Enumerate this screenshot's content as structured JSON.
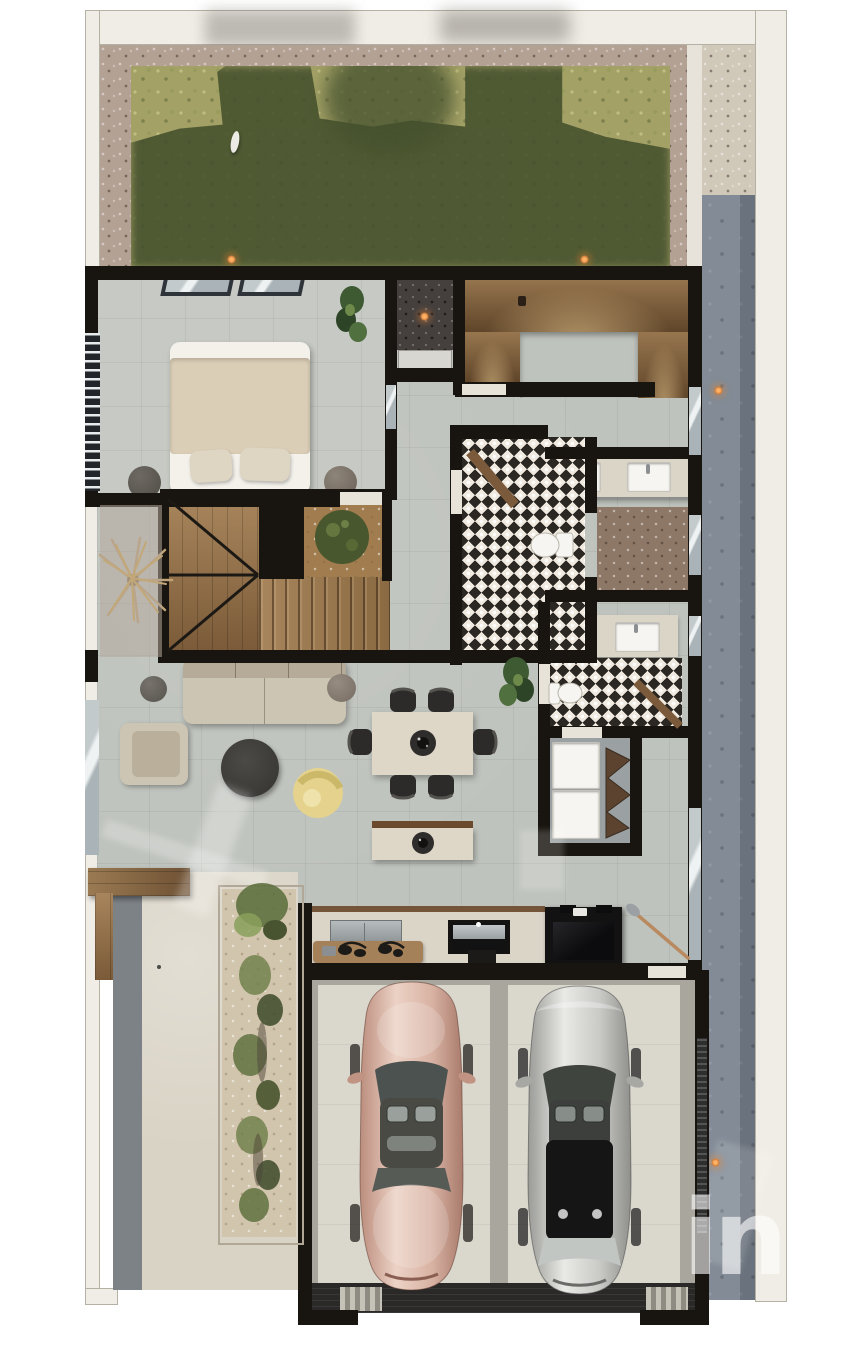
{
  "watermark": {
    "text": "in"
  },
  "palette": {
    "page-bg": "#ffffff",
    "outer-wall": "#f0ede6",
    "outer-wall-edge": "#b6b1a5",
    "wall": "#18140f",
    "door-threshold": "#e7e3d9",
    "garden-gravel": "#b3a193",
    "grass-light": "#a3a166",
    "grass-dark": "#44502d",
    "fence-light": "#e7e3da",
    "path-beige": "#d0c9ba",
    "path-blue": "#828b96",
    "floor": "#bfc3bd",
    "floor-bedroom": "#c7cac4",
    "tile-base": "#efe9df",
    "tile-dark": "#2b2723",
    "niche-gravel": "#45403e",
    "patio-gravel": "#8d7868",
    "planter-clay": "#a07c4e",
    "sand": "#d2c5ad",
    "walkway": "#d9d3c5",
    "strip-gray": "#7c8286",
    "deck-wood": "#7b5a3d",
    "bed-white": "#f3f1ea",
    "duvet": "#dbceb7",
    "pillow": "#ded5c2",
    "sofa": "#cdc5b3",
    "rug": "#3b3a37",
    "accent-yellow": "#e4d28d",
    "table": "#ded7c7",
    "chair-dark": "#2c2b29",
    "counter": "#dbd5c8",
    "steel": "#a8adaf",
    "appliance": "#121212",
    "fixture-white": "#f6f5f1",
    "laundry-floor": "#9ba1a2",
    "garage-base": "#a9a79d",
    "garage-pad": "#dad7cd",
    "garage-entry": "#2b2927",
    "car-rose": "#d8b2a3",
    "car-silver": "#c9c9c6",
    "plant-green": "#5c6e3c",
    "plant-dark": "#36432a",
    "plant-light": "#8aa05a",
    "dried-plant": "#bfa277",
    "glass": "#aab1b7",
    "orange-light": "#d07e3b",
    "watermark-color": "rgba(255,255,255,0.6)"
  }
}
